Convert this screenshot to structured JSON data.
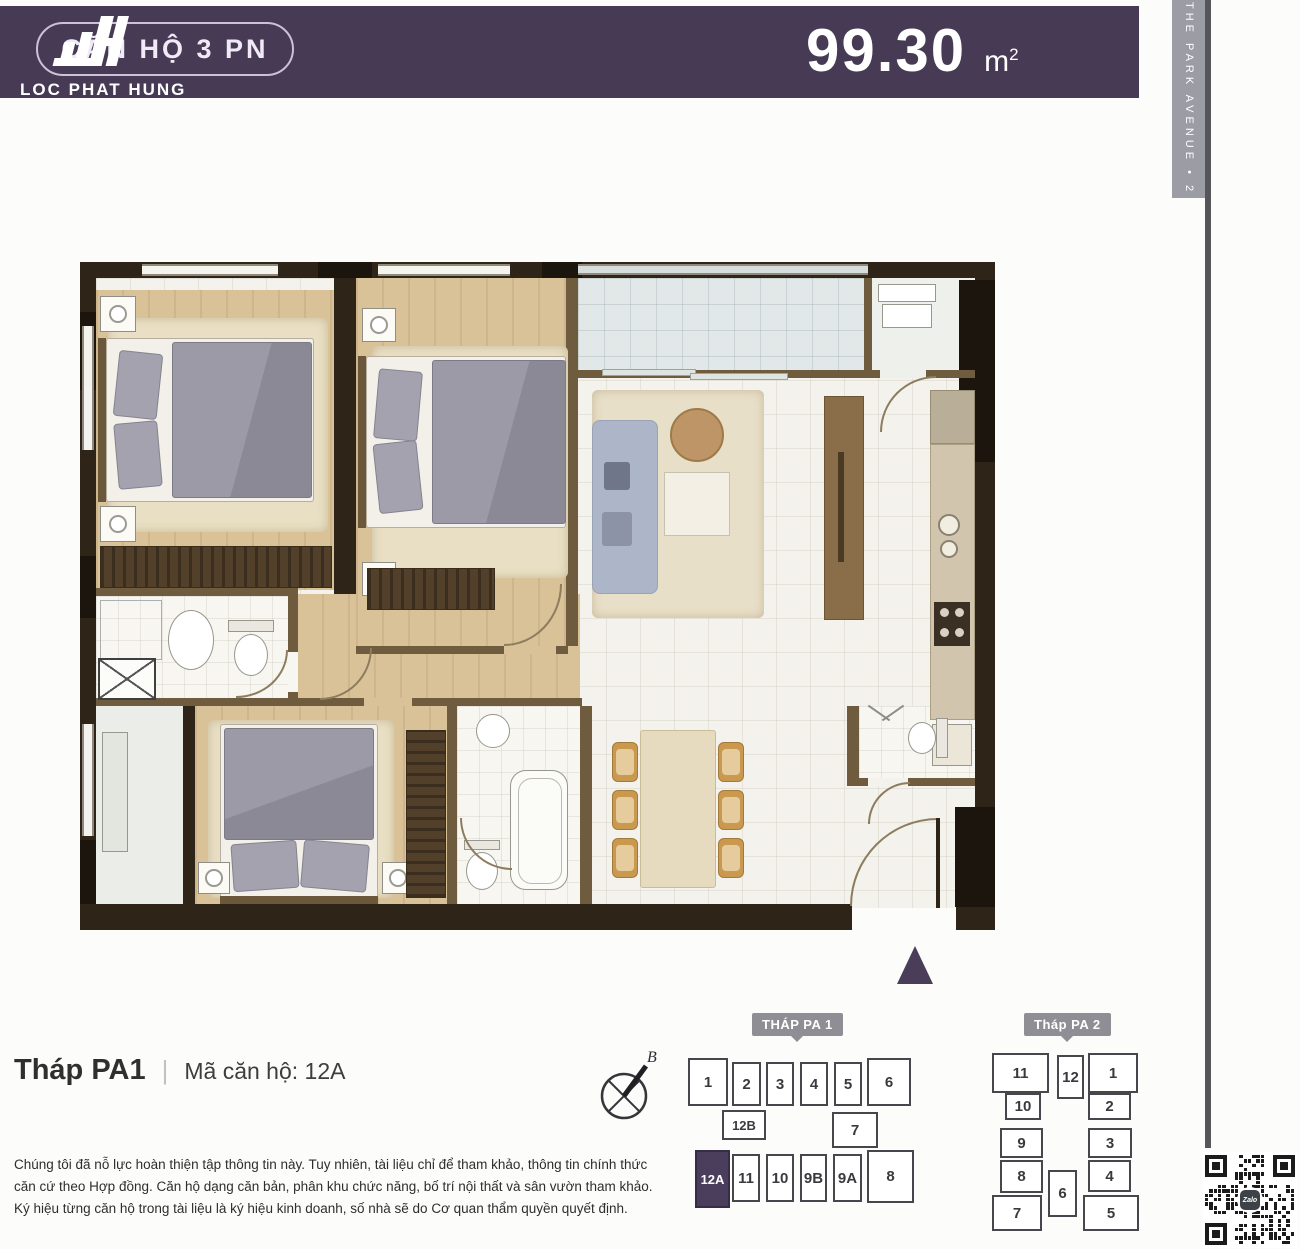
{
  "header": {
    "badge_label": "CĂN HỘ 3 PN",
    "area_value": "99.30",
    "area_unit": "m",
    "area_sup": "2",
    "logo_text": "LOC PHAT HUNG",
    "bg_color": "#473a54"
  },
  "ribbon": {
    "text": "THE PARK AVENUE • 2"
  },
  "unit_info": {
    "tower": "Tháp PA1",
    "divider": "|",
    "code": "Mã căn hộ: 12A"
  },
  "compass": {
    "label": "B"
  },
  "towers": {
    "pa1": {
      "label": "THÁP PA 1",
      "units": [
        "1",
        "2",
        "3",
        "4",
        "5",
        "6",
        "12B",
        "7",
        "12A",
        "11",
        "10",
        "9B",
        "9A",
        "8"
      ],
      "highlight": "12A"
    },
    "pa2": {
      "label": "Tháp PA 2",
      "units": [
        "11",
        "10",
        "9",
        "8",
        "7",
        "12",
        "6",
        "1",
        "2",
        "3",
        "4",
        "5"
      ]
    }
  },
  "disclaimer": {
    "lines": [
      "Chúng tôi đã nỗ lực hoàn thiện tập thông tin này. Tuy nhiên, tài liệu chỉ để tham khảo, thông tin chính thức",
      "căn cứ theo Hợp đồng. Căn hộ dạng căn bản, phân khu chức năng, bố trí nội thất và sân vườn tham khảo.",
      "Ký hiệu từng căn hộ trong tài liệu là ký hiệu kinh doanh, số nhà sẽ do Cơ quan thẩm quyền quyết định."
    ]
  },
  "qr": {
    "label": "Zalo"
  },
  "colors": {
    "accent_purple": "#4b3d5c",
    "header_purple": "#473a54",
    "ribbon_gray": "#9c9ca4",
    "tag_gray": "#8e8e94",
    "wall_dark": "#2e2417",
    "wood_floor": "#d9c198",
    "bed_gray": "#8f8e9a",
    "sofa_blue": "#adb5c8",
    "chair_tan": "#c8994f"
  }
}
